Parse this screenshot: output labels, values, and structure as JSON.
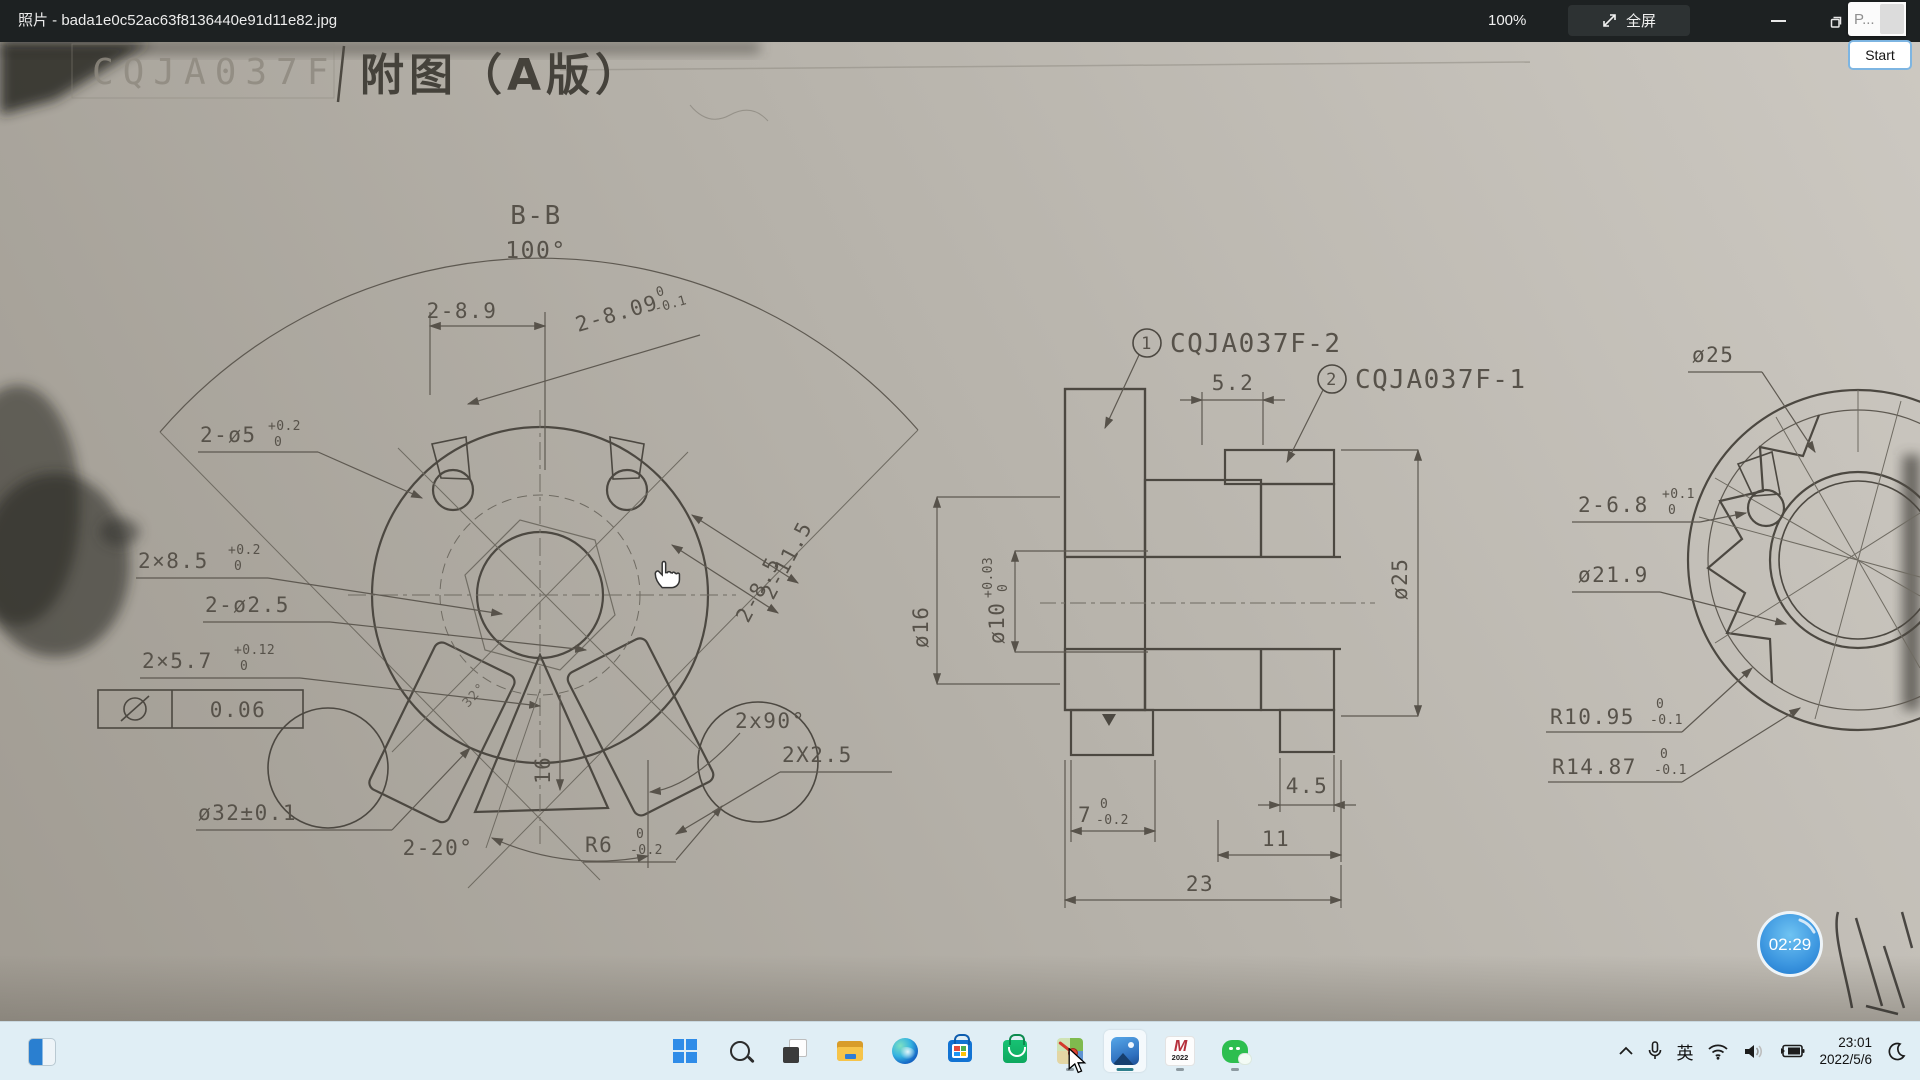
{
  "window": {
    "title": "照片 - bada1e0c52ac63f8136440e91d11e82.jpg",
    "zoom_level": "100%",
    "fullscreen_label": "全屏",
    "popup": {
      "truncated_text": "P...",
      "start_label": "Start"
    }
  },
  "drawing": {
    "header": {
      "code": "CQJA037F",
      "sheet_title": "附图（A版）"
    },
    "left_view": {
      "section": "B-B",
      "fan_angle": "100°",
      "d_2_89": "2-8.9",
      "d_2_809": "2-8.09",
      "d_2_809_t": "0",
      "d_2_809_b": "-0.1",
      "d_2_o5": "2-ø5",
      "d_2_o5_t": "+0.2",
      "d_2_o5_b": "0",
      "d_2x85": "2×8.5",
      "d_2x85_t": "+0.2",
      "d_2x85_b": "0",
      "d_2_o25": "2-ø2.5",
      "d_2x57": "2×5.7",
      "d_2x57_t": "+0.12",
      "d_2x57_b": "0",
      "tol_frame": "0.06",
      "d_o32": "ø32±0.1",
      "d_2_20": "2-20°",
      "d_r6": "R6",
      "d_r6_t": "0",
      "d_r6_b": "-0.2",
      "d_2x25": "2X2.5",
      "d_2x90": "2x90°",
      "d_2_115": "2-11.5",
      "d_2_85": "2-8.5",
      "d_16": "16",
      "d_32deg": "32°"
    },
    "middle_view": {
      "balloon1": "1",
      "part1": "CQJA037F-2",
      "balloon2": "2",
      "part2": "CQJA037F-1",
      "d_52": "5.2",
      "d_o16": "ø16",
      "d_o10": "ø10",
      "d_o10_t": "+0.03",
      "d_o10_b": "0",
      "d_o25": "ø25",
      "d_7": "7",
      "d_7_t": "0",
      "d_7_b": "-0.2",
      "d_45": "4.5",
      "d_11": "11",
      "d_23": "23"
    },
    "right_view": {
      "d_o25": "ø25",
      "d_2_68": "2-6.8",
      "d_2_68_t": "+0.1",
      "d_2_68_b": "0",
      "d_o219": "ø21.9",
      "d_r1095": "R10.95",
      "d_r1095_t": "0",
      "d_r1095_b": "-0.1",
      "d_r1487": "R14.87",
      "d_r1487_t": "0",
      "d_r1487_b": "-0.1"
    }
  },
  "overlay": {
    "timer": "02:29"
  },
  "taskbar": {
    "ime": "英",
    "clock": {
      "time": "23:01",
      "date": "2022/5/6"
    },
    "m_app": {
      "letter": "M",
      "year": "2022"
    },
    "icons": [
      "split-view",
      "start",
      "search",
      "task-view",
      "file-explorer",
      "edge",
      "store",
      "green-bag-store",
      "image-map-viewer",
      "photos",
      "m-2022",
      "wechat"
    ]
  }
}
